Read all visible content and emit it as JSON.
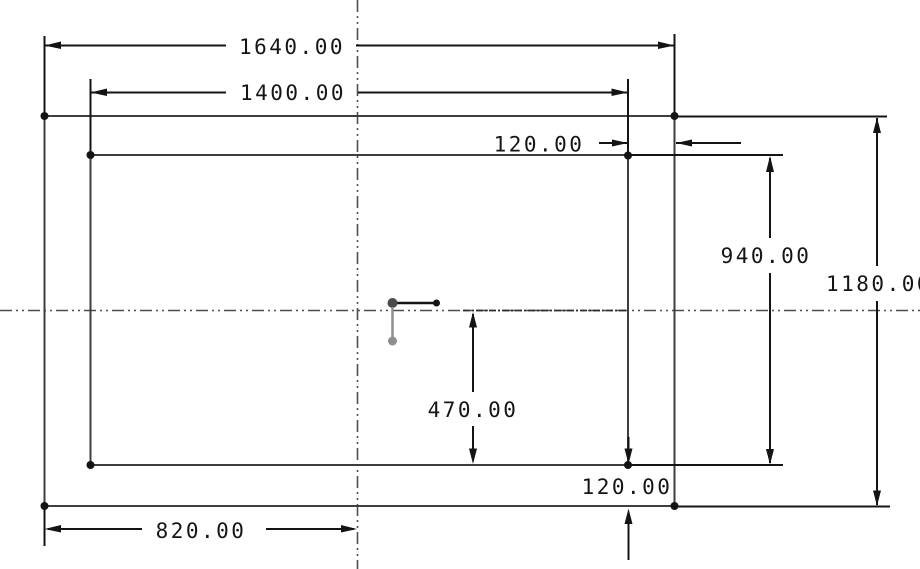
{
  "drawing": {
    "type": "cad-2d-dimensioned-sketch",
    "colors": {
      "background": "#ffffff",
      "dimension_lines": "#141414",
      "geometry_edges": "#3e3e3e",
      "centerlines": "#4f4f4f",
      "construction": "#8f8f8f"
    },
    "dims": {
      "outer_width": "1640.00",
      "inner_width": "1400.00",
      "top_right_offset": "120.00",
      "inner_height": "940.00",
      "outer_height": "1180.00",
      "center_to_bottom": "470.00",
      "bottom_right_offset": "120.00",
      "half_width": "820.00"
    }
  }
}
